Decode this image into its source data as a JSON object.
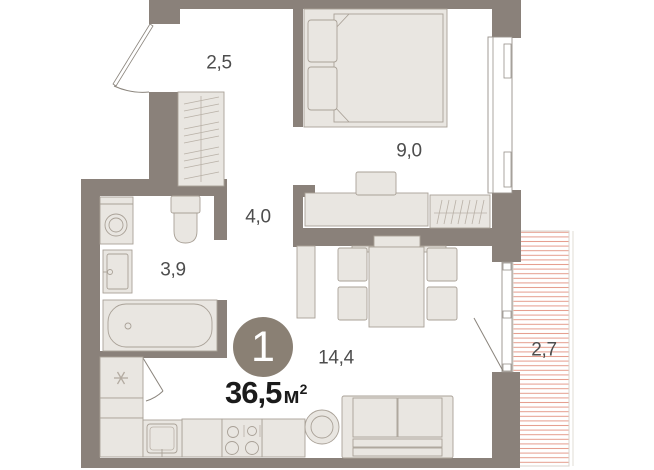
{
  "plan": {
    "unit_number": "1",
    "total_area": {
      "value": "36,5",
      "unit": "м",
      "sup": "2"
    },
    "rooms": [
      {
        "id": "hallway",
        "area": "2,5"
      },
      {
        "id": "bedroom",
        "area": "9,0"
      },
      {
        "id": "corridor",
        "area": "4,0"
      },
      {
        "id": "bathroom",
        "area": "3,9"
      },
      {
        "id": "living-kitchen",
        "area": "14,4"
      },
      {
        "id": "balcony",
        "area": "2,7"
      }
    ],
    "symbols": {
      "utility_star": "✳"
    },
    "colors": {
      "wall": "#8A817A",
      "furniture_fill": "#E9E6E1",
      "furniture_stroke": "#A9A197",
      "balcony_hatch": "#E59B8B",
      "badge": "#8A8074",
      "label_text": "#4D4D4D",
      "area_text": "#1B1B1B"
    }
  }
}
